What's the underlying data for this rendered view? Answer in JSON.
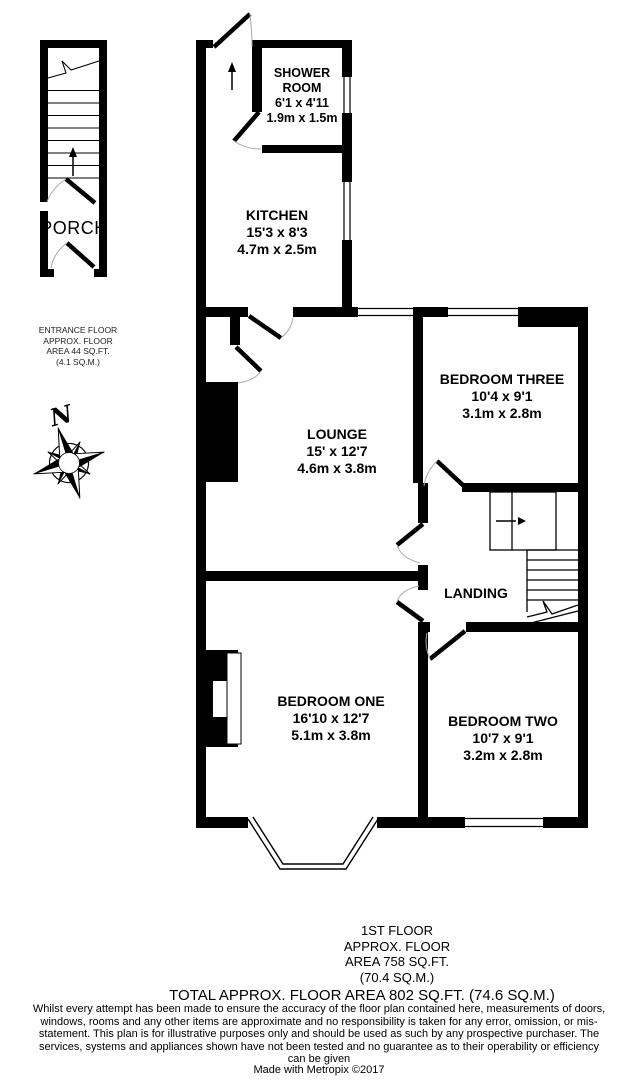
{
  "rooms": {
    "porch": {
      "name": "PORCH"
    },
    "shower_room": {
      "name": "SHOWER ROOM",
      "imperial": "6'1 x 4'11",
      "metric": "1.9m x 1.5m"
    },
    "kitchen": {
      "name": "KITCHEN",
      "imperial": "15'3 x 8'3",
      "metric": "4.7m x 2.5m"
    },
    "lounge": {
      "name": "LOUNGE",
      "imperial": "15' x 12'7",
      "metric": "4.6m x 3.8m"
    },
    "bedroom_three": {
      "name": "BEDROOM THREE",
      "imperial": "10'4 x 9'1",
      "metric": "3.1m x 2.8m"
    },
    "landing": {
      "name": "LANDING"
    },
    "bedroom_one": {
      "name": "BEDROOM ONE",
      "imperial": "16'10 x 12'7",
      "metric": "5.1m x 3.8m"
    },
    "bedroom_two": {
      "name": "BEDROOM TWO",
      "imperial": "10'7 x 9'1",
      "metric": "3.2m x 2.8m"
    }
  },
  "entrance_floor_note": {
    "line1": "ENTRANCE FLOOR",
    "line2": "APPROX. FLOOR",
    "line3": "AREA 44 SQ.FT.",
    "line4": "(4.1 SQ.M.)"
  },
  "compass": {
    "north": "N"
  },
  "footer": {
    "floor_block": {
      "line1": "1ST FLOOR",
      "line2": "APPROX. FLOOR",
      "line3": "AREA 758 SQ.FT.",
      "line4": "(70.4 SQ.M.)"
    },
    "total": "TOTAL APPROX. FLOOR AREA 802 SQ.FT. (74.6 SQ.M.)",
    "disclaimer": "Whilst every attempt has been made to ensure the accuracy of the floor plan contained here, measurements of doors, windows, rooms and any other items are approximate and no responsibility is taken for any error, omission, or mis-statement. This plan is for illustrative purposes only and should be used as such by any prospective purchaser. The services, systems and appliances shown have not been tested and no guarantee as to their operability or efficiency can be given",
    "credit": "Made with Metropix ©2017"
  },
  "colors": {
    "wall": "#000000",
    "background": "#ffffff"
  }
}
